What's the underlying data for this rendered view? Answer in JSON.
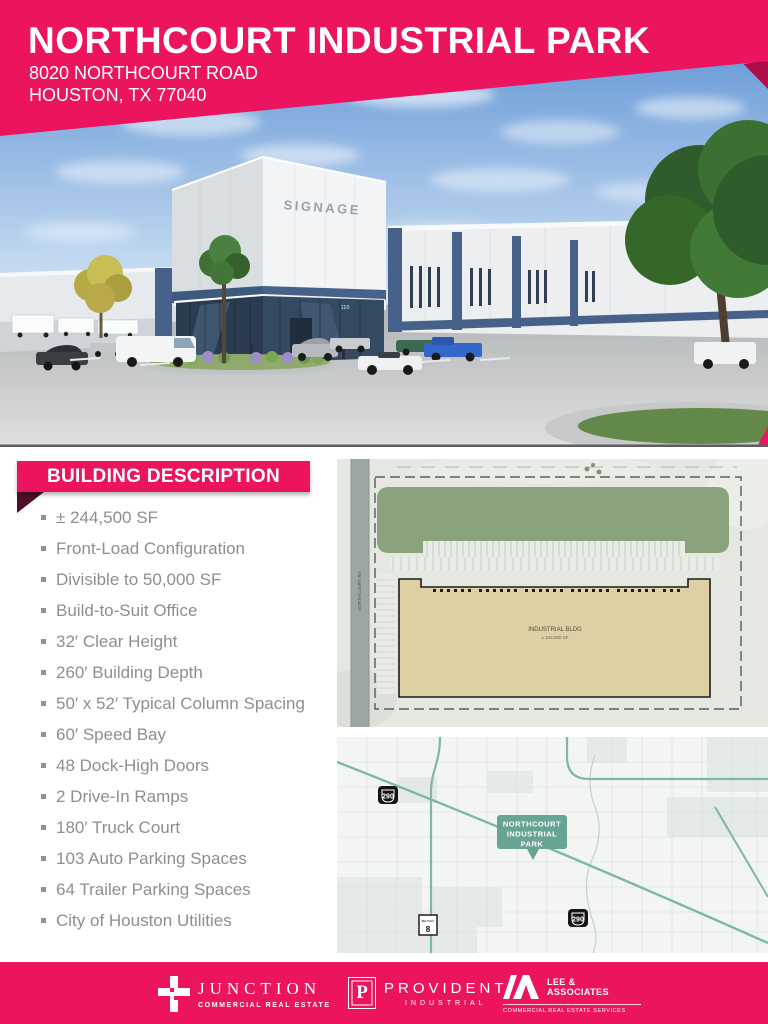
{
  "colors": {
    "brand_pink": "#EC145E",
    "banner_fold_dark": "#4D0F2A",
    "header_fold": "#AD0D4B",
    "body_text_gray": "#8C8E91",
    "map_road_teal": "#7CB8A4",
    "plan_green": "#8AA37C",
    "plan_building_tan": "#DDD1A3"
  },
  "header": {
    "title": "NORTHCOURT INDUSTRIAL PARK",
    "address_line1": "8020 NORTHCOURT ROAD",
    "address_line2": "HOUSTON, TX 77040"
  },
  "rendering": {
    "signage": "SIGNAGE",
    "suite_number": "110"
  },
  "building_description": {
    "heading": "BUILDING DESCRIPTION",
    "items": [
      "± 244,500 SF",
      "Front-Load Configuration",
      "Divisible to 50,000 SF",
      "Build-to-Suit Office",
      "32′ Clear Height",
      "260′ Building Depth",
      "50′ x 52′ Typical Column Spacing",
      "60′ Speed Bay",
      "48 Dock-High Doors",
      "2 Drive-In Ramps",
      "180′ Truck Court",
      "103 Auto Parking Spaces",
      "64 Trailer Parking Spaces",
      "City of Houston Utilities"
    ]
  },
  "site_plan": {
    "building_label": "INDUSTRIAL BLDG",
    "building_area": "± 244,500 SF",
    "road_label": "NORTHCOURT RD"
  },
  "map": {
    "callout_line1": "NORTHCOURT",
    "callout_line2": "INDUSTRIAL",
    "callout_line3": "PARK",
    "shield_290_top": "290",
    "shield_290_bottom": "290",
    "shield_beltway_label": "BELTWAY",
    "shield_beltway_number": "8"
  },
  "footer": {
    "junction": {
      "name": "JUNCTION",
      "tagline": "COMMERCIAL REAL ESTATE"
    },
    "provident": {
      "initial": "P",
      "name": "PROVIDENT",
      "tagline": "INDUSTRIAL"
    },
    "lee": {
      "name_line1": "LEE &",
      "name_line2": "ASSOCIATES",
      "tagline": "COMMERCIAL REAL ESTATE SERVICES"
    }
  }
}
